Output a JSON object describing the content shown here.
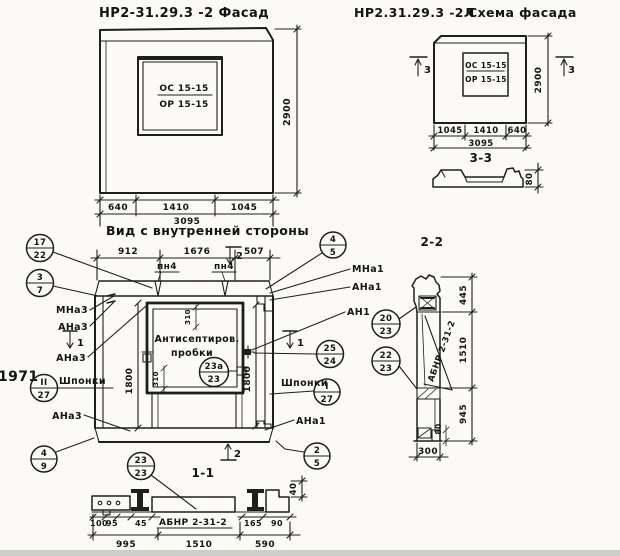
{
  "facade_view": {
    "title": "НР2-31.29.3 -2 Фасад",
    "window_mark_top": "ОС 15-15",
    "window_mark_bottom": "ОР 15-15",
    "height_dim": "2900",
    "width_dims": [
      "640",
      "1410",
      "1045"
    ],
    "total_dim": "3095"
  },
  "schema_view": {
    "title_code": "НР2.31.29.3 -2Л",
    "title_name": "Схема фасада",
    "window_mark_top": "ОС 15-15",
    "window_mark_bottom": "ОР 15-15",
    "height_dim": "2900",
    "width_dims": [
      "1045",
      "1410",
      "640"
    ],
    "total_dim": "3095",
    "section_mark": "3"
  },
  "section_33": {
    "title": "3-3",
    "thickness_dim": "80"
  },
  "inner_view": {
    "title": "Вид с внутренней стороны",
    "top_dims": [
      "912",
      "1676",
      "507"
    ],
    "joint_label": "пн4",
    "height_dim": "1800",
    "window_dim": "310",
    "note_line1": "Антисептиров.",
    "note_line2": "пробки",
    "keys_label": "Шпонки",
    "year_stamp": "1971",
    "section1_mark": "1",
    "section2_mark": "2",
    "labels": {
      "mna3": "МНа3",
      "ana3": "АНа3",
      "mna1": "МНа1",
      "ana1": "АНа1",
      "an1": "АН1"
    },
    "balloons": {
      "b17_22": {
        "top": "17",
        "bottom": "22"
      },
      "b3_7": {
        "top": "3",
        "bottom": "7"
      },
      "b4_5": {
        "top": "4",
        "bottom": "5"
      },
      "b25_24": {
        "top": "25",
        "bottom": "24"
      },
      "b1_27": {
        "top": "I",
        "bottom": "27"
      },
      "b11_27": {
        "top": "II",
        "bottom": "27"
      },
      "b23a_23": {
        "top": "23а",
        "bottom": "23"
      },
      "b4_9": {
        "top": "4",
        "bottom": "9"
      },
      "b2_5": {
        "top": "2",
        "bottom": "5"
      }
    }
  },
  "section_11": {
    "title": "1-1",
    "beam_mark": "АБНР 2-31-2",
    "balloon": {
      "top": "23",
      "bottom": "23"
    },
    "small_dims": [
      "100",
      "95",
      "45",
      "165",
      "90"
    ],
    "depth_dim": "40",
    "bottom_dims": [
      "995",
      "1510",
      "590"
    ]
  },
  "section_22": {
    "title": "2-2",
    "beam_mark": "АБНР 2-31-2",
    "right_dims": [
      "445",
      "1510",
      "945"
    ],
    "bottom_dim": "300",
    "notch_dim": "80",
    "balloons": {
      "b20_23": {
        "top": "20",
        "bottom": "23"
      },
      "b22_23": {
        "top": "22",
        "bottom": "23"
      }
    }
  }
}
